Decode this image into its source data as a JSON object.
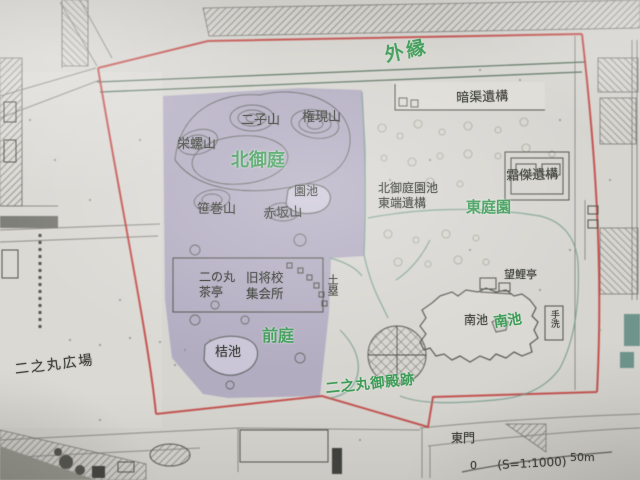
{
  "colors": {
    "label_green": "#3f9c58",
    "label_dark": "#3b3e37",
    "boundary_red": "#c2403e",
    "overlay_purple": "#7e74ab",
    "teal_patch": "#55857c",
    "paper": "#d7d5d0"
  },
  "map": {
    "labels": {
      "outer_edge": "外縁",
      "culvert_remains": "暗渠遺構",
      "futagoyama": "二子山",
      "gongenyama": "権現山",
      "sazaeyama": "栄螺山",
      "kita_oniwa": "北御庭",
      "enchi": "園池",
      "sasamakiyama": "笹巻山",
      "akasakayama": "赤坂山",
      "pond_east_end_line1": "北御庭園池",
      "pond_east_end_line2": "東端遺構",
      "higashi_teien": "東庭園",
      "soketsu_remains": "霜傑遺構",
      "ninomaru_chatei_line1": "二の丸",
      "ninomaru_chatei_line2": "茶亭",
      "officers_hall_line1": "旧将校",
      "officers_hall_line2": "集会所",
      "dorui": "土塁",
      "bogitei": "望鯉亭",
      "minami_ike": "南池",
      "minami_ike_green": "南池",
      "tearai": "手洗",
      "zentei": "前庭",
      "kitsu_ike": "桔池",
      "ninomaru_hiroba": "二之丸広場",
      "ninomaru_goten_ato": "二之丸御殿跡",
      "higashi_mon": "東門"
    },
    "scale": {
      "zero": "0",
      "ratio": "(S=1:1000)",
      "distance": "50m"
    }
  }
}
